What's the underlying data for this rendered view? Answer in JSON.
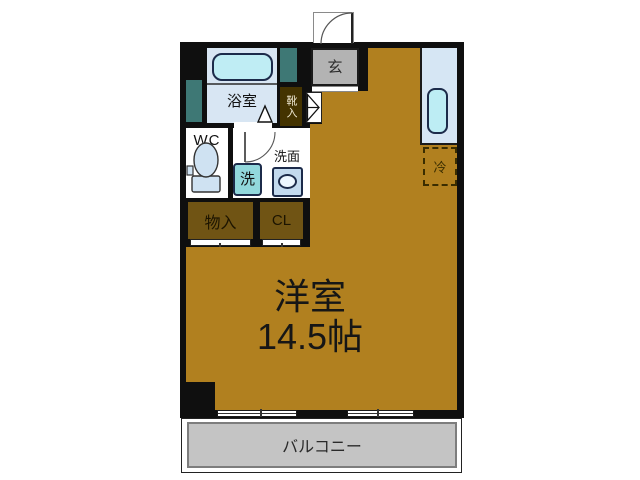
{
  "plan": {
    "labels": {
      "bathroom": "浴室",
      "wc": "WC",
      "washroom": "洗面",
      "washer": "洗",
      "shoe_cabinet": "靴入",
      "entrance": "玄",
      "storage": "物入",
      "closet": "CL",
      "fridge": "冷",
      "main_room_name": "洋室",
      "main_room_size": "14.5帖",
      "balcony": "バルコニー"
    },
    "colors": {
      "wall": "#0f0f0f",
      "floor": "#B1801F",
      "bathroom_fill": "#D8E6F3",
      "fixture_cyan": "#BFEDF4",
      "duct_teal": "#3E7875",
      "shoe_box_brown": "#443300",
      "storage_brown": "#705414",
      "entrance_gray": "#B3B3B3",
      "balcony_gray": "#C4C4C4",
      "washer_teal": "#92D8DC"
    }
  }
}
